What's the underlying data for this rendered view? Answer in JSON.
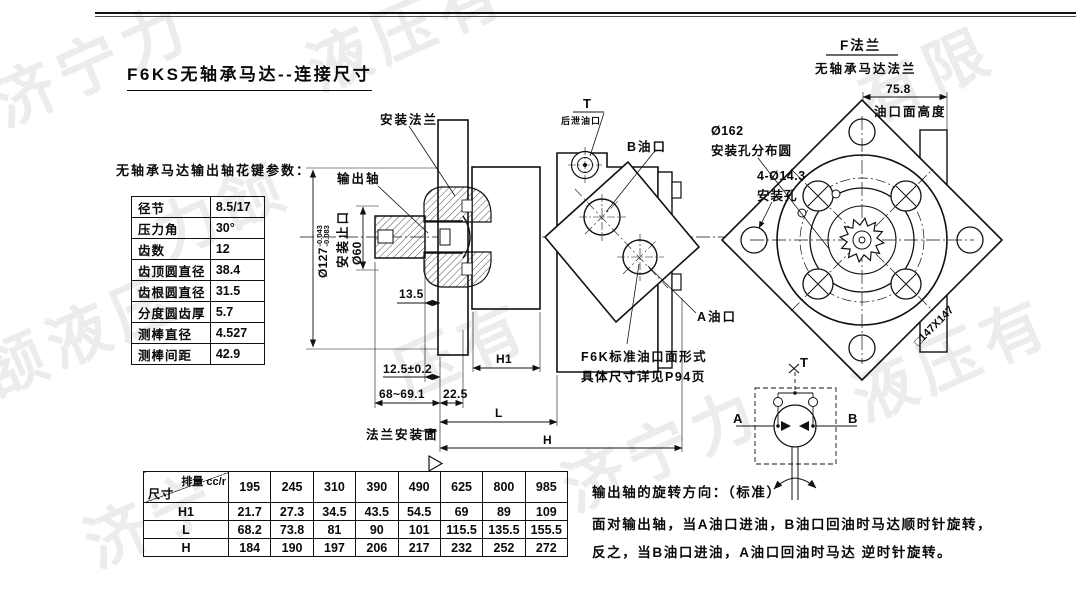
{
  "title": "F6KS无轴承马达--连接尺寸",
  "watermark_fragments": [
    "济宁力",
    "液压有",
    "有限",
    "力颔",
    "颔液压",
    "压有",
    "液压有",
    "济宁力",
    "济宁"
  ],
  "spline": {
    "caption": "无轴承马达输出轴花键参数：",
    "rows": [
      {
        "label": "径节",
        "value": "8.5/17"
      },
      {
        "label": "压力角",
        "value": "30°"
      },
      {
        "label": "齿数",
        "value": "12"
      },
      {
        "label": "齿顶圆直径",
        "value": "38.4"
      },
      {
        "label": "齿根圆直径",
        "value": "31.5"
      },
      {
        "label": "分度圆齿厚",
        "value": "5.7"
      },
      {
        "label": "测棒直径",
        "value": "4.527"
      },
      {
        "label": "测棒间距",
        "value": "42.9"
      }
    ]
  },
  "side_view": {
    "mounting_flange": "安装法兰",
    "output_shaft": "输出轴",
    "t_port": "T",
    "t_port_note": "后泄油口",
    "b_port": "B油口",
    "a_port": "A油口",
    "port_note1": "F6K标准油口面形式",
    "port_note2": "具体尺寸详见P94页",
    "flange_face": "法兰安装面",
    "pilot_label": "安装止口",
    "dia127": "Ø127",
    "dia127_tol_up": "-0.043",
    "dia127_tol_low": "-0.083",
    "dia60": "Ø60",
    "dim_13_5": "13.5",
    "dim_12_5": "12.5±0.2",
    "dim_68": "68~69.1",
    "dim_22_5": "22.5",
    "dim_h1": "H1",
    "dim_l": "L",
    "dim_h": "H"
  },
  "flange_view": {
    "title": "F法兰",
    "subtitle": "无轴承马达法兰",
    "dim_75_8": "75.8",
    "port_face_height": "油口面高度",
    "bolt_circle_dia": "Ø162",
    "bolt_circle_label": "安装孔分布圆",
    "mount_holes": "4-Ø14.3",
    "mount_holes_label": "安装孔",
    "square_dim": "□147X147"
  },
  "schematic": {
    "port_a": "A",
    "port_b": "B",
    "port_t": "T"
  },
  "disp_table": {
    "corner_top": "排量 cc/r",
    "corner_bottom": "尺寸",
    "columns": [
      "195",
      "245",
      "310",
      "390",
      "490",
      "625",
      "800",
      "985"
    ],
    "rows": [
      {
        "label": "H1",
        "values": [
          "21.7",
          "27.3",
          "34.5",
          "43.5",
          "54.5",
          "69",
          "89",
          "109"
        ]
      },
      {
        "label": "L",
        "values": [
          "68.2",
          "73.8",
          "81",
          "90",
          "101",
          "115.5",
          "135.5",
          "155.5"
        ]
      },
      {
        "label": "H",
        "values": [
          "184",
          "190",
          "197",
          "206",
          "217",
          "232",
          "252",
          "272"
        ]
      }
    ]
  },
  "rotation_note": {
    "line1": "输出轴的旋转方向：（标准）",
    "line2": "面对输出轴，当A油口进油，B油口回油时马达顺时针旋转，",
    "line3": "反之，当B油口进油，A油口回油时马达 逆时针旋转。"
  }
}
